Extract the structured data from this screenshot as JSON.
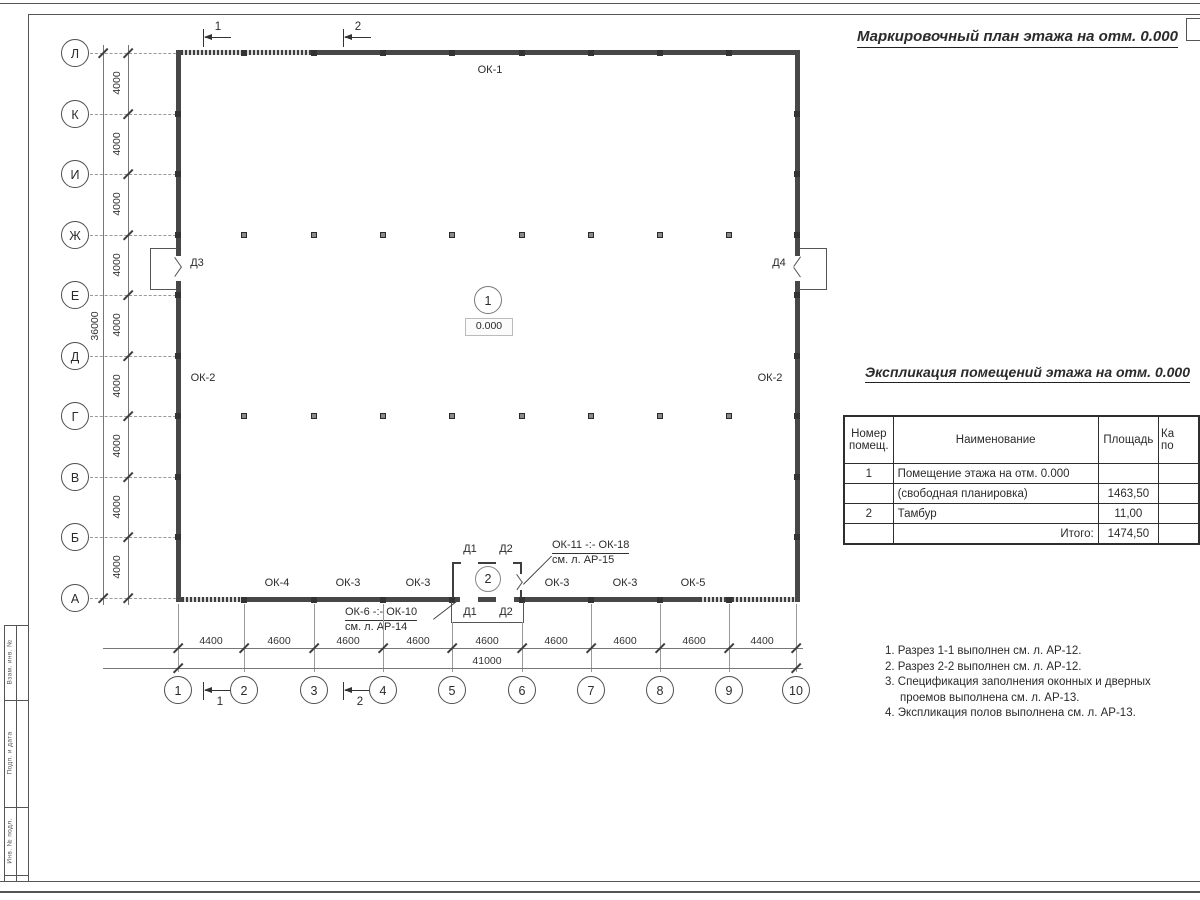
{
  "title": "Маркировочный план этажа на отм. 0.000",
  "plan": {
    "grid": {
      "rows": [
        "Л",
        "К",
        "И",
        "Ж",
        "Е",
        "Д",
        "Г",
        "В",
        "Б",
        "А"
      ],
      "cols": [
        "1",
        "2",
        "3",
        "4",
        "5",
        "6",
        "7",
        "8",
        "9",
        "10"
      ],
      "row_dims": [
        "4000",
        "4000",
        "4000",
        "4000",
        "4000",
        "4000",
        "4000",
        "4000",
        "4000"
      ],
      "row_total": "36000",
      "col_dims": [
        "4400",
        "4600",
        "4600",
        "4600",
        "4600",
        "4600",
        "4600",
        "4600",
        "4400"
      ],
      "col_total": "41000"
    },
    "sections": {
      "s1": "1",
      "s2": "2"
    },
    "rooms": {
      "r1": {
        "num": "1",
        "level": "0.000"
      },
      "r2": {
        "num": "2"
      }
    },
    "windows": {
      "top": "ОК-1",
      "left": "ОК-2",
      "right": "ОК-2",
      "bottom": [
        "ОК-4",
        "ОК-3",
        "ОК-3",
        "ОК-3",
        "ОК-3",
        "ОК-5"
      ]
    },
    "doors": {
      "d3": "Д3",
      "d4": "Д4",
      "d1": "Д1",
      "d2": "Д2"
    },
    "leaders": {
      "top": {
        "l1": "ОК-11 -:- ОК-18",
        "l2": "см. л. АР-15"
      },
      "bottom": {
        "l1": "ОК-6 -:- ОК-10",
        "l2": "см. л. АР-14"
      }
    }
  },
  "table": {
    "title": "Экспликация помещений этажа на отм. 0.000",
    "headers": {
      "num": "Номер помещ.",
      "name": "Наименование",
      "area": "Площадь",
      "cat1": "Ка",
      "cat2": "по"
    },
    "rows": [
      {
        "num": "1",
        "name": "Помещение этажа на отм. 0.000",
        "area": ""
      },
      {
        "num": "",
        "name": "(свободная планировка)",
        "area": "1463,50"
      },
      {
        "num": "2",
        "name": "Тамбур",
        "area": "11,00"
      },
      {
        "num": "",
        "name": "Итого:",
        "area": "1474,50"
      }
    ]
  },
  "notes": [
    "1. Разрез 1-1 выполнен см. л. АР-12.",
    "2. Разрез 2-2 выполнен см. л. АР-12.",
    "3. Спецификация заполнения оконных и дверных проемов выполнена см. л. АР-13.",
    "4. Экспликация полов выполнена см. л. АР-13."
  ],
  "stamp": {
    "c1": "Взам. инв. №",
    "c2": "Подп. и дата",
    "c3": "Инв. № подл."
  }
}
